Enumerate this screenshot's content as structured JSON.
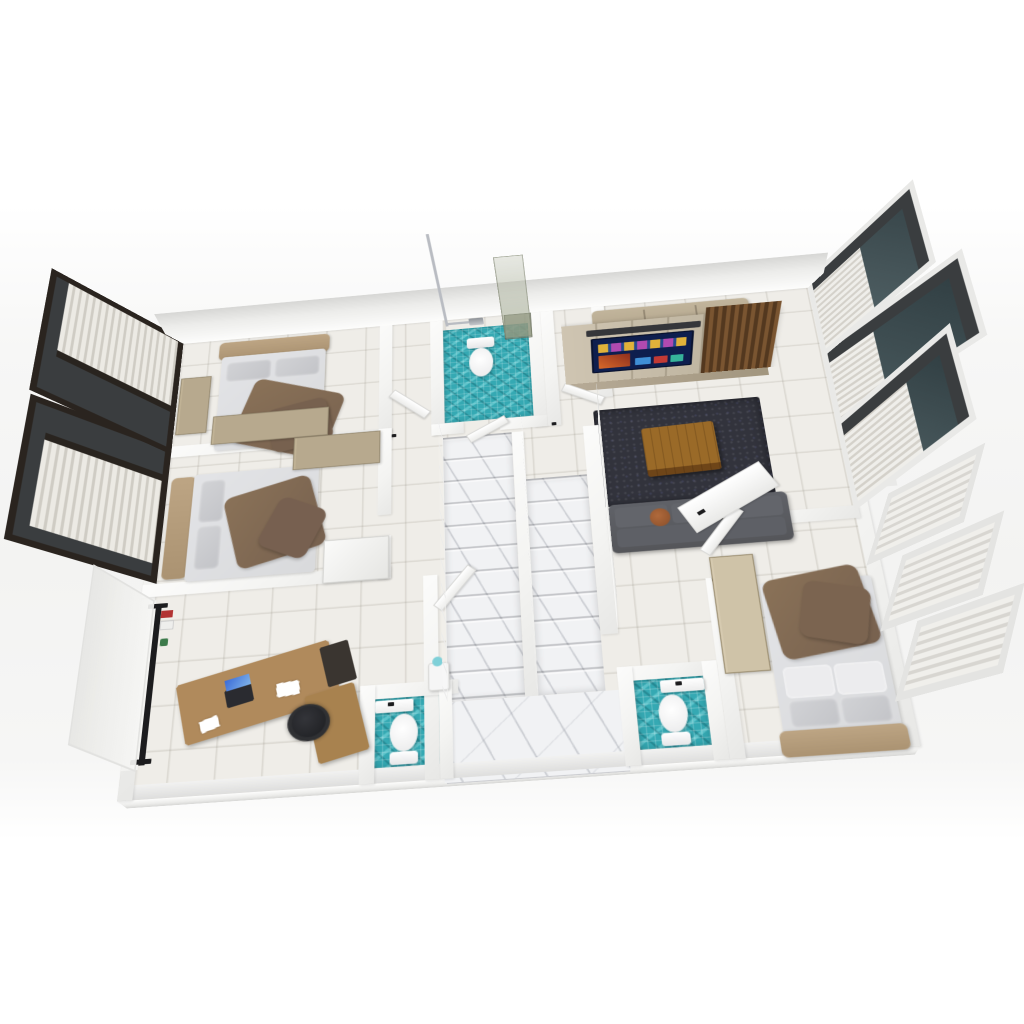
{
  "scene": {
    "title": "3D rendered floor plan – apartment upper storey",
    "view": "elevated three-quarter top view, white studio background",
    "background": "#ffffff"
  },
  "palette": {
    "tile": "#efede8",
    "wall": "#f4f4f2",
    "teal": "#35a9b3",
    "marble": "#f1f2f4",
    "wood": "#b08a5c",
    "wood-dark": "#6e4518",
    "sheet": "#d9dadc",
    "blanket": "#8a7258",
    "headboard": "#ab9372",
    "cabinet": "#b7a98e",
    "rug": "#32333c",
    "sofa": "#55565a",
    "tv-screen": "#0e1e4e",
    "glass": "#46565a",
    "shower-glass": "#9aa08c",
    "chrome": "#b9bcc2",
    "black": "#1c1c1e"
  },
  "rooms": [
    {
      "id": "bedroom-top-left",
      "label": "bedroom with double bed and wardrobe"
    },
    {
      "id": "bedroom-mid-left",
      "label": "bedroom with double bed and wardrobes"
    },
    {
      "id": "office",
      "label": "study with L-desk, office chair and clothes rack"
    },
    {
      "id": "bathroom-top",
      "label": "bathroom with shower, toilet, teal mosaic floor"
    },
    {
      "id": "hallway",
      "label": "tiled hallway"
    },
    {
      "id": "stairwell",
      "label": "double marble staircase with landing"
    },
    {
      "id": "bathroom-bottom-left",
      "label": "toilet room, teal mosaic floor"
    },
    {
      "id": "bathroom-bottom-right",
      "label": "toilet room, teal mosaic floor"
    },
    {
      "id": "living-room",
      "label": "TV lounge with media wall, rug, sofas"
    },
    {
      "id": "bedroom-bottom-right",
      "label": "bedroom with double bed and casement windows"
    }
  ],
  "furniture": [
    "bed",
    "pillows",
    "brown-throw-blanket",
    "wardrobe",
    "desk",
    "laptop",
    "office-chair",
    "clothes-rack",
    "tv-media-wall",
    "smart-tv",
    "soundbar",
    "beige-sofa",
    "dark-sofa",
    "accent-pillows",
    "shag-rug",
    "coffee-table"
  ],
  "fixtures": [
    "toilet",
    "wall-counter",
    "rain-shower-column",
    "glass-shower-panel",
    "sliding-window-blinds",
    "casement-windows-with-sheer-curtains",
    "stair-railing",
    "door-leaf",
    "water-dispenser"
  ]
}
